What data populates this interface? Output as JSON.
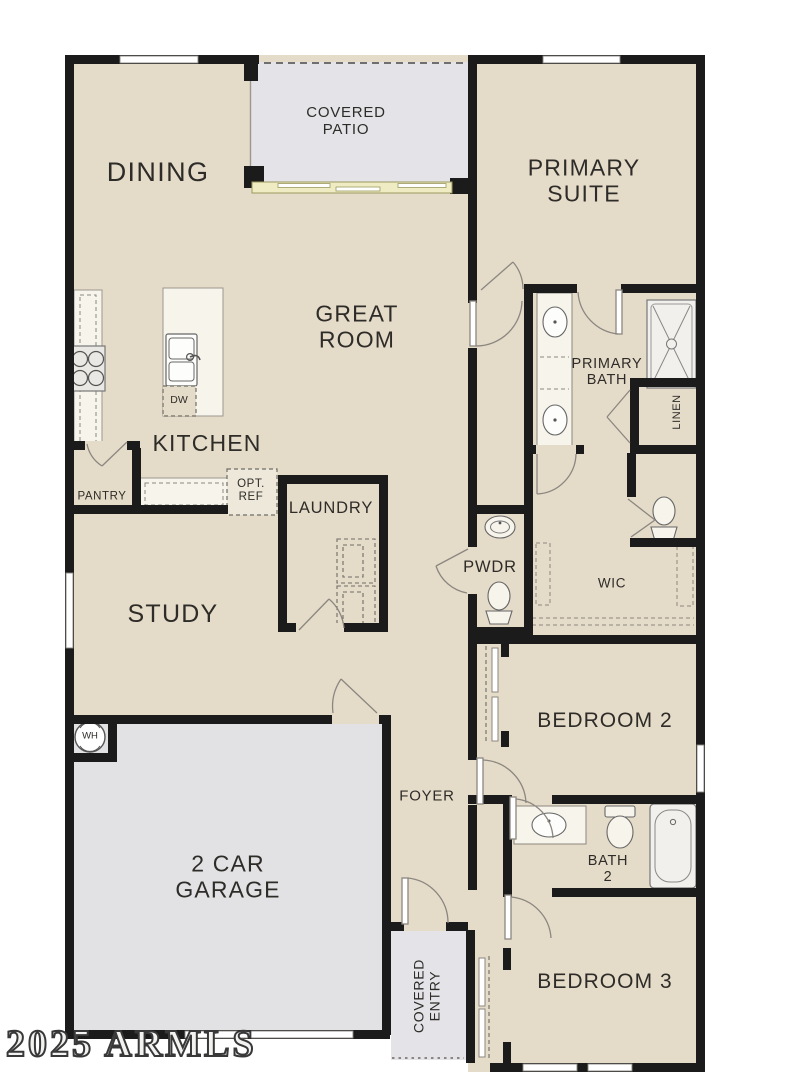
{
  "plan": {
    "rooms": {
      "dining": {
        "label": "DINING"
      },
      "covered_patio": {
        "label": "COVERED\nPATIO"
      },
      "primary_suite": {
        "label": "PRIMARY\nSUITE"
      },
      "great_room": {
        "label": "GREAT\nROOM"
      },
      "kitchen": {
        "label": "KITCHEN"
      },
      "pantry": {
        "label": "PANTRY"
      },
      "laundry": {
        "label": "LAUNDRY"
      },
      "primary_bath": {
        "label": "PRIMARY\nBATH"
      },
      "linen": {
        "label": "LINEN"
      },
      "powder": {
        "label": "PWDR"
      },
      "wic": {
        "label": "WIC"
      },
      "study": {
        "label": "STUDY"
      },
      "bedroom_2": {
        "label": "BEDROOM 2"
      },
      "foyer": {
        "label": "FOYER"
      },
      "bath_2": {
        "label": "BATH\n2"
      },
      "garage": {
        "label": "2 CAR\nGARAGE"
      },
      "bedroom_3": {
        "label": "BEDROOM 3"
      },
      "covered_entry": {
        "label": "COVERED\nENTRY"
      }
    },
    "fixtures": {
      "dishwasher": "DW",
      "water_heater": "WH",
      "optional_refrigerator": "OPT.\nREF"
    },
    "watermark": "2025 ARMLS",
    "colors": {
      "floor": "#e5dbc9",
      "exterior_concrete": "#e3e2e6",
      "wall": "#1b1b1b",
      "sliding_door": "#efecc3"
    }
  }
}
